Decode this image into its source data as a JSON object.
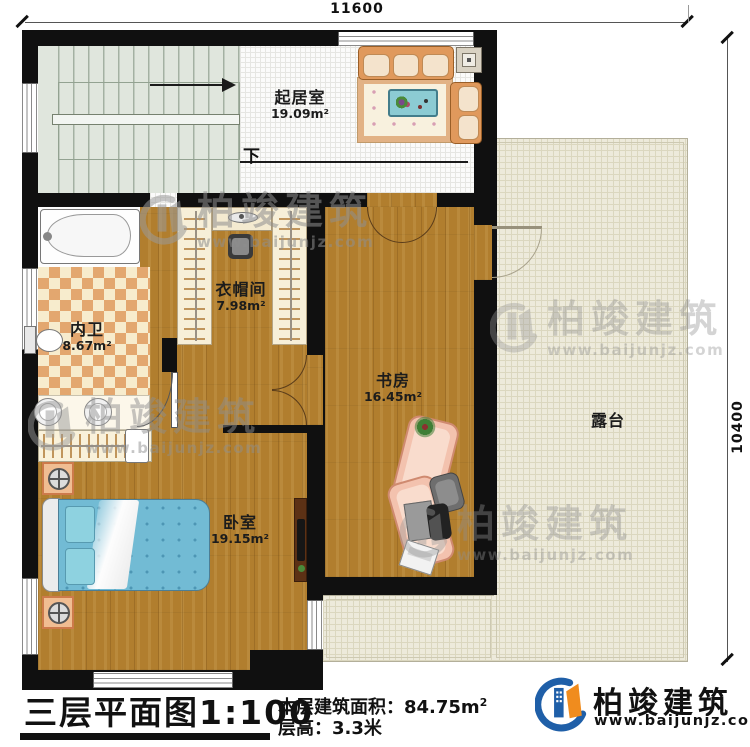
{
  "dims": {
    "top": "11600",
    "right": "10400"
  },
  "stairs": {
    "down": "下"
  },
  "rooms": {
    "living": {
      "name": "起居室",
      "area": "19.09m²"
    },
    "cloak": {
      "name": "衣帽间",
      "area": "7.98m²"
    },
    "bath": {
      "name": "内卫",
      "area": "8.67m²"
    },
    "study": {
      "name": "书房",
      "area": "16.45m²"
    },
    "bedroom": {
      "name": "卧室",
      "area": "19.15m²"
    },
    "terrace": {
      "name": "露台"
    }
  },
  "footer": {
    "title": "三层平面图",
    "scale": "1:100",
    "area_label": "本层建筑面积：",
    "area_value": "84.75m",
    "area_sup": "2",
    "height_text": "层高：3.3米"
  },
  "brand": {
    "name": "柏竣建筑",
    "url": "www.baijunjz.com"
  }
}
